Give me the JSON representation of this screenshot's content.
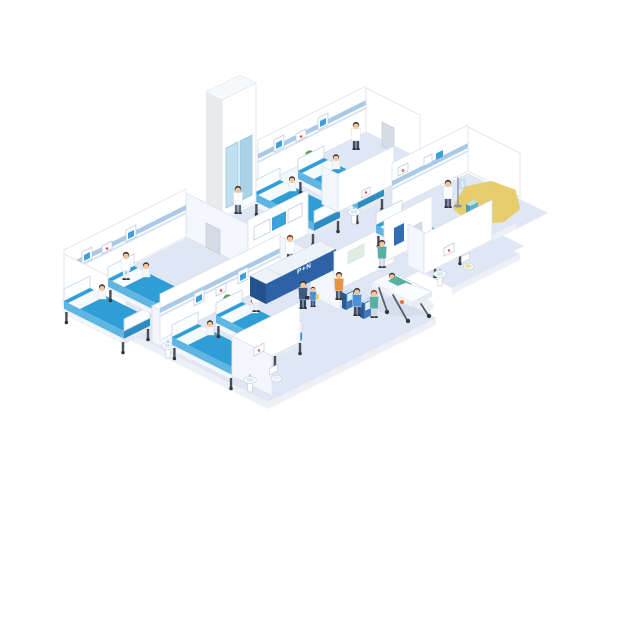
{
  "illustration": {
    "subject": "isometric hospital ward floor",
    "style": "flat isometric cutaway"
  },
  "reception": {
    "sign": "P+N"
  },
  "inventory": {
    "ward_rooms": 4,
    "beds": 7,
    "patients_in_beds": 7,
    "patients_on_gurney": 1,
    "staff_figures": 7,
    "other_figures": 5,
    "self_service_kiosks": 2,
    "bathrooms": 4,
    "elevators": 1,
    "reception_desks": 1,
    "gurneys": 1,
    "potted_plants": 7,
    "wall_monitors": 3
  },
  "palette": {
    "floor": "#dfe6f4",
    "floor_edge": "#edf0f6",
    "wall": "#ffffff",
    "wall_shade": "#f3f6fb",
    "wall_stroke": "#dbe2ec",
    "stripe_blue": "#a9c9e7",
    "stripe_light": "#d3e2f2",
    "bed_top": "#2f9ed6",
    "bed_side": "#5fb6e2",
    "bed_side_dark": "#2d8cc0",
    "sheet": "#f5fafd",
    "leg_dark": "#4a4f57",
    "desk_front": "#2e62a6",
    "desk_side": "#24528f",
    "desk_top": "#eef3fa",
    "screen_blue": "#3da0d8",
    "elevator_door": "#bfe0ee",
    "shaft_side": "#e8eaec",
    "plant_green": "#5aa156",
    "plant_green_dark": "#4a8c4e",
    "plant_green_light": "#6cb062",
    "skin": "#f2c69a",
    "hair_dark": "#38302a",
    "coat_white": "#ffffff",
    "scrubs_teal": "#57b0a2",
    "scrubs_navy": "#3d5a80",
    "shirt_orange": "#e8923f",
    "shirt_blue": "#4a90d9",
    "gown_white": "#f4f6f9",
    "highlight_yellow": "#e7cd6b",
    "poster_blue": "#2f6db4",
    "board_green": "#dfeee1",
    "door_gray": "#d6dce6",
    "art_red": "#d9534f"
  }
}
